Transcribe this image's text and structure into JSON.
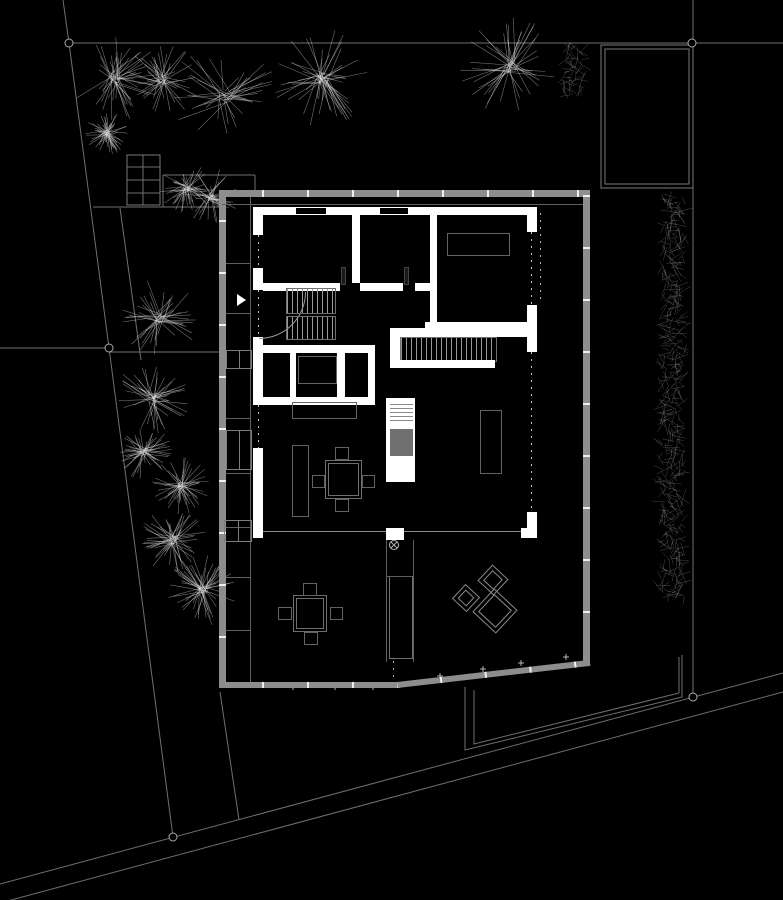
{
  "meta": {
    "drawing_type": "architectural-site-floor-plan",
    "canvas": {
      "width": 783,
      "height": 900
    },
    "background": "#000000"
  },
  "colors": {
    "wall": "#ffffff",
    "deck": "#8d8d8d",
    "line": "#6f6f6f",
    "tree": "#e6e6e6",
    "hedge": "#d2d2d2",
    "furniture": "#636363",
    "marker": "#aaaaaa"
  },
  "site": {
    "lines": [
      [
        69,
        43,
        783,
        43
      ],
      [
        693,
        0,
        693,
        697
      ],
      [
        0,
        348,
        109,
        348
      ],
      [
        109,
        352,
        219,
        352
      ],
      [
        93,
        207,
        219,
        207
      ],
      [
        120,
        208,
        141,
        360
      ],
      [
        163,
        175,
        255,
        175
      ],
      [
        163,
        175,
        163,
        207
      ],
      [
        255,
        175,
        255,
        190
      ],
      [
        0,
        884,
        783,
        673
      ],
      [
        0,
        903,
        783,
        692
      ],
      [
        220,
        692,
        239,
        820
      ],
      [
        127,
        167,
        160,
        167
      ],
      [
        127,
        180,
        160,
        180
      ],
      [
        127,
        193,
        160,
        193
      ],
      [
        143,
        155,
        143,
        205
      ]
    ],
    "polylines": [
      [
        [
          63,
          0
        ],
        [
          69,
          43
        ],
        [
          109,
          348
        ],
        [
          173,
          837
        ]
      ],
      [
        [
          465,
          687
        ],
        [
          465,
          750
        ],
        [
          682,
          697
        ],
        [
          682,
          655
        ]
      ],
      [
        [
          474,
          690
        ],
        [
          474,
          744
        ],
        [
          679,
          693
        ],
        [
          679,
          657
        ]
      ]
    ],
    "rects": [
      {
        "x": 127,
        "y": 155,
        "w": 33,
        "h": 50
      },
      {
        "x": 601,
        "y": 45,
        "w": 92,
        "h": 143
      },
      {
        "x": 605,
        "y": 49,
        "w": 84,
        "h": 135
      }
    ],
    "markers": [
      [
        69,
        43
      ],
      [
        692,
        43
      ],
      [
        109,
        348
      ],
      [
        173,
        837
      ],
      [
        693,
        697
      ]
    ],
    "trees": [
      {
        "x": 115,
        "y": 78,
        "r": 44
      },
      {
        "x": 162,
        "y": 80,
        "r": 38
      },
      {
        "x": 225,
        "y": 96,
        "r": 55
      },
      {
        "x": 322,
        "y": 78,
        "r": 50
      },
      {
        "x": 107,
        "y": 133,
        "r": 22
      },
      {
        "x": 186,
        "y": 188,
        "r": 27
      },
      {
        "x": 211,
        "y": 197,
        "r": 29
      },
      {
        "x": 511,
        "y": 67,
        "r": 52
      },
      {
        "x": 160,
        "y": 318,
        "r": 40
      },
      {
        "x": 152,
        "y": 398,
        "r": 38
      },
      {
        "x": 144,
        "y": 452,
        "r": 28
      },
      {
        "x": 181,
        "y": 486,
        "r": 30
      },
      {
        "x": 173,
        "y": 540,
        "r": 33
      },
      {
        "x": 203,
        "y": 590,
        "r": 36
      }
    ],
    "hedges": [
      {
        "x": 672,
        "y1": 197,
        "y2": 600,
        "hw": 15
      },
      {
        "x": 575,
        "y1": 46,
        "y2": 96,
        "hw": 13
      }
    ],
    "plus_marks": [
      [
        293,
        687
      ],
      [
        335,
        687
      ],
      [
        373,
        687
      ],
      [
        440,
        676
      ],
      [
        483,
        669
      ],
      [
        521,
        663
      ],
      [
        566,
        657
      ]
    ],
    "drain": {
      "x": 394,
      "y": 545,
      "r": 4.5
    }
  }
}
